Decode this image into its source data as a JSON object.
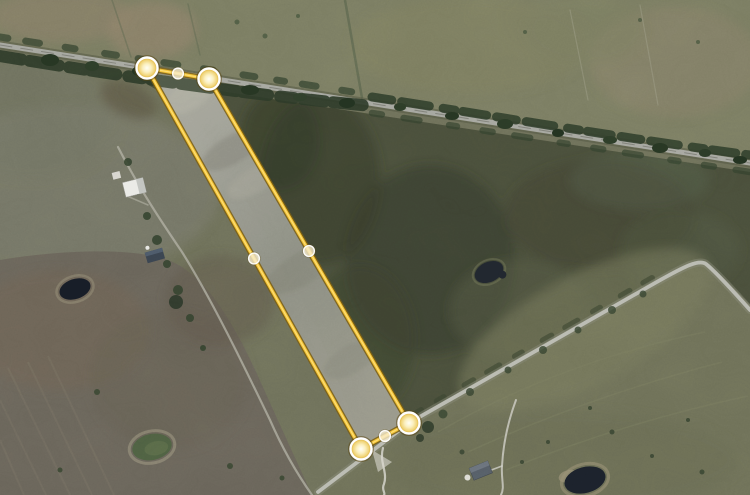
{
  "canvas": {
    "width": 750,
    "height": 495
  },
  "overlay": {
    "kind": "parcel-boundary-editor",
    "boundary_color": "#F2C235",
    "boundary_outline_color": "#7C5F12",
    "boundary_highlight_color": "#FFE27E",
    "fill_color": "rgba(250,243,220,0.13)",
    "vertex_handle": {
      "radius": 10.5,
      "ring_color": "#FFFFFF"
    },
    "midpoint_handle": {
      "radius": 5.4,
      "fill": "rgba(246,236,206,0.8)"
    },
    "vertices": [
      {
        "x": 147,
        "y": 68
      },
      {
        "x": 209,
        "y": 79
      },
      {
        "x": 409,
        "y": 423
      },
      {
        "x": 361,
        "y": 449
      }
    ],
    "midpoints": [
      {
        "x": 178,
        "y": 73.5
      },
      {
        "x": 309,
        "y": 251
      },
      {
        "x": 385,
        "y": 436
      },
      {
        "x": 254,
        "y": 258.5
      }
    ]
  }
}
